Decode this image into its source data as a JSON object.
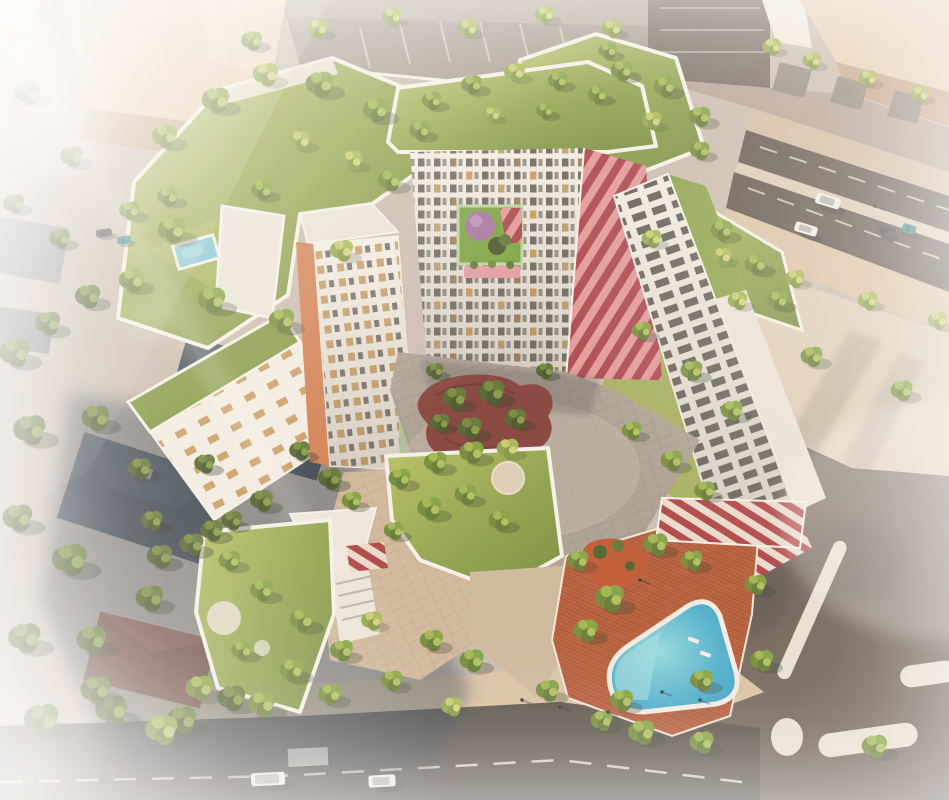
{
  "palette": {
    "ground": "#c7bcb1",
    "road": "#5a524b",
    "road_bottom": "#534e49",
    "asphalt_br": "#6d635b",
    "sidewalk": "#d8c2a6",
    "plaza": "#dccfbb",
    "court_paver": "#a89f95",
    "warm_paver": "#cdb79d",
    "beige_lit": "#e4cfb6",
    "beige_shadow": "#c0a287",
    "white_bldg": "#f3f0ea",
    "parapet": "#f6f3ee",
    "window_dark": "#5f5b57",
    "window_tan": "#c79c62",
    "red": "#a63f4a",
    "red_light": "#e0969b",
    "grass": "#97aa4e",
    "grass_light": "#b7c161",
    "grass_dark": "#748d3b",
    "pool": "#3fa9cf",
    "pool_light": "#9adfe6",
    "pool_rim": "#f3efe8",
    "deck": "#b45a39",
    "mulch": "#bf5330",
    "maroon": "#7e3c38",
    "roof_neighbor": "#3c4955",
    "roof_neighbor2": "#3a4753",
    "roof_brown": "#8e4b38",
    "shadow_blue": "#2b3a50",
    "mint": "#bcd6a8",
    "orange": "#d07b4f",
    "dome": "#a06fa0",
    "banner_pink": "#e09aa0",
    "car_white": "#f0efec",
    "car_dark": "#46464a",
    "car_teal": "#2f7f82"
  },
  "scene": {
    "trees": [
      [
        15,
        355,
        1.3,
        2
      ],
      [
        48,
        325,
        1.1,
        2
      ],
      [
        88,
        298,
        1.1,
        2
      ],
      [
        30,
        432,
        1.4,
        2
      ],
      [
        96,
        420,
        1.2,
        2
      ],
      [
        18,
        520,
        1.3,
        2
      ],
      [
        70,
        562,
        1.5,
        2
      ],
      [
        25,
        640,
        1.4,
        2
      ],
      [
        92,
        642,
        1.3,
        2
      ],
      [
        150,
        600,
        1.2,
        2
      ],
      [
        42,
        722,
        1.5,
        2
      ],
      [
        112,
        712,
        1.4,
        2
      ],
      [
        182,
        722,
        1.3,
        2
      ],
      [
        232,
        700,
        1.2,
        2
      ],
      [
        160,
        558,
        1.1,
        2
      ],
      [
        212,
        532,
        1.0,
        2
      ],
      [
        262,
        502,
        1.0,
        2
      ],
      [
        205,
        465,
        0.9,
        2
      ],
      [
        300,
        452,
        0.9,
        2
      ],
      [
        330,
        480,
        1.0,
        2
      ],
      [
        140,
        470,
        1.0,
        2
      ],
      [
        28,
        95,
        1.1,
        2
      ],
      [
        72,
        158,
        1.0,
        2
      ],
      [
        14,
        205,
        0.9,
        2
      ],
      [
        130,
        212,
        0.9,
        1
      ],
      [
        168,
        198,
        0.9,
        1
      ],
      [
        60,
        240,
        0.9,
        2
      ],
      [
        318,
        30,
        0.9,
        3
      ],
      [
        392,
        18,
        0.85,
        3
      ],
      [
        468,
        30,
        0.85,
        3
      ],
      [
        545,
        16,
        0.85,
        3
      ],
      [
        612,
        30,
        0.85,
        3
      ],
      [
        252,
        42,
        0.9,
        1
      ],
      [
        772,
        48,
        0.8,
        3
      ],
      [
        812,
        62,
        0.8,
        3
      ],
      [
        868,
        80,
        0.8,
        3
      ],
      [
        920,
        96,
        0.8,
        3
      ],
      [
        652,
        240,
        0.85,
        3
      ],
      [
        722,
        258,
        0.85,
        3
      ],
      [
        795,
        280,
        0.85,
        3
      ],
      [
        868,
        302,
        0.85,
        3
      ],
      [
        938,
        322,
        0.85,
        3
      ],
      [
        812,
        358,
        0.95,
        1
      ],
      [
        902,
        392,
        0.95,
        1
      ],
      [
        96,
        692,
        1.3,
        2
      ],
      [
        162,
        732,
        1.4,
        1
      ],
      [
        200,
        690,
        1.2,
        1
      ],
      [
        262,
        706,
        1.2,
        1
      ],
      [
        330,
        696,
        1.0,
        1
      ],
      [
        452,
        708,
        0.9,
        3
      ],
      [
        548,
        692,
        1.0,
        1
      ],
      [
        622,
        702,
        1.0,
        1
      ],
      [
        702,
        682,
        1.0,
        1
      ],
      [
        762,
        662,
        1.0,
        1
      ],
      [
        875,
        748,
        1.1,
        1
      ],
      [
        165,
        138,
        1.1,
        1
      ],
      [
        216,
        102,
        1.2,
        1
      ],
      [
        266,
        76,
        1.1,
        3
      ],
      [
        320,
        86,
        1.2,
        1
      ],
      [
        376,
        112,
        1.1,
        1
      ],
      [
        300,
        142,
        0.95,
        3
      ],
      [
        172,
        232,
        1.2,
        1
      ],
      [
        132,
        282,
        1.1,
        1
      ],
      [
        212,
        302,
        1.2,
        1
      ],
      [
        282,
        322,
        1.1,
        1
      ],
      [
        342,
        252,
        1.0,
        3
      ],
      [
        390,
        182,
        1.0,
        1
      ],
      [
        420,
        132,
        0.9,
        1
      ],
      [
        352,
        162,
        0.95,
        3
      ],
      [
        262,
        192,
        0.9,
        1
      ],
      [
        432,
        102,
        0.85,
        1
      ],
      [
        472,
        86,
        0.9,
        1
      ],
      [
        515,
        74,
        0.9,
        3
      ],
      [
        558,
        82,
        0.85,
        1
      ],
      [
        598,
        96,
        0.85,
        1
      ],
      [
        545,
        112,
        0.75,
        1
      ],
      [
        492,
        116,
        0.75,
        3
      ],
      [
        622,
        72,
        0.95,
        1
      ],
      [
        665,
        88,
        0.95,
        1
      ],
      [
        700,
        118,
        0.95,
        1
      ],
      [
        652,
        122,
        0.85,
        3
      ],
      [
        608,
        52,
        0.8,
        1
      ],
      [
        700,
        152,
        0.85,
        1
      ],
      [
        722,
        232,
        0.95,
        1
      ],
      [
        756,
        266,
        0.95,
        1
      ],
      [
        778,
        302,
        0.9,
        1
      ],
      [
        738,
        302,
        0.85,
        3
      ],
      [
        642,
        332,
        0.85,
        1
      ],
      [
        692,
        372,
        0.95,
        1
      ],
      [
        732,
        412,
        0.95,
        1
      ],
      [
        632,
        432,
        0.85,
        1
      ],
      [
        672,
        462,
        0.95,
        1
      ],
      [
        705,
        492,
        0.9,
        1
      ],
      [
        455,
        400,
        1.05,
        2
      ],
      [
        492,
        394,
        1.15,
        2
      ],
      [
        470,
        430,
        1.05,
        2
      ],
      [
        516,
        420,
        0.95,
        2
      ],
      [
        440,
        424,
        0.85,
        2
      ],
      [
        435,
        372,
        0.75,
        2
      ],
      [
        545,
        372,
        0.75,
        2
      ],
      [
        400,
        480,
        0.95,
        1
      ],
      [
        436,
        464,
        1.0,
        1
      ],
      [
        472,
        454,
        1.05,
        1
      ],
      [
        508,
        450,
        0.95,
        3
      ],
      [
        430,
        510,
        1.05,
        1
      ],
      [
        466,
        496,
        0.95,
        1
      ],
      [
        500,
        522,
        0.95,
        1
      ],
      [
        394,
        532,
        0.85,
        1
      ],
      [
        352,
        502,
        0.85,
        1
      ],
      [
        230,
        562,
        0.95,
        1
      ],
      [
        262,
        592,
        1.0,
        1
      ],
      [
        302,
        622,
        1.05,
        1
      ],
      [
        342,
        652,
        1.0,
        1
      ],
      [
        292,
        672,
        1.05,
        1
      ],
      [
        242,
        652,
        0.9,
        1
      ],
      [
        372,
        622,
        0.9,
        3
      ],
      [
        432,
        642,
        1.0,
        1
      ],
      [
        472,
        662,
        1.05,
        1
      ],
      [
        392,
        682,
        0.95,
        1
      ],
      [
        610,
        600,
        1.25,
        1
      ],
      [
        586,
        632,
        1.05,
        1
      ],
      [
        656,
        546,
        1.05,
        1
      ],
      [
        692,
        562,
        0.95,
        1
      ],
      [
        756,
        586,
        0.95,
        1
      ],
      [
        642,
        734,
        1.15,
        1
      ],
      [
        702,
        744,
        1.05,
        1
      ],
      [
        602,
        722,
        0.95,
        1
      ],
      [
        578,
        562,
        0.95,
        1
      ],
      [
        152,
        522,
        0.95,
        2
      ],
      [
        192,
        546,
        1.05,
        2
      ],
      [
        232,
        522,
        0.9,
        2
      ]
    ],
    "cars": [
      {
        "x": 268,
        "y": 779,
        "w": 34,
        "h": 13,
        "r": -3,
        "c": "car_white"
      },
      {
        "x": 382,
        "y": 781,
        "w": 27,
        "h": 12,
        "r": -3,
        "c": "car_white"
      },
      {
        "x": 828,
        "y": 201,
        "w": 25,
        "h": 11,
        "r": 17,
        "c": "car_white"
      },
      {
        "x": 806,
        "y": 229,
        "w": 23,
        "h": 10,
        "r": 17,
        "c": "car_white"
      },
      {
        "x": 886,
        "y": 231,
        "w": 19,
        "h": 10,
        "r": 17,
        "c": "car_dark"
      },
      {
        "x": 909,
        "y": 229,
        "w": 14,
        "h": 9,
        "r": 17,
        "c": "car_teal"
      },
      {
        "x": 104,
        "y": 233,
        "w": 16,
        "h": 8,
        "r": -8,
        "c": "car_dark"
      },
      {
        "x": 124,
        "y": 240,
        "w": 14,
        "h": 8,
        "r": -8,
        "c": "car_teal"
      }
    ],
    "people": [
      [
        522,
        700
      ],
      [
        560,
        707
      ],
      [
        608,
        712
      ],
      [
        662,
        692
      ],
      [
        700,
        700
      ],
      [
        875,
        206
      ],
      [
        640,
        580
      ]
    ]
  }
}
